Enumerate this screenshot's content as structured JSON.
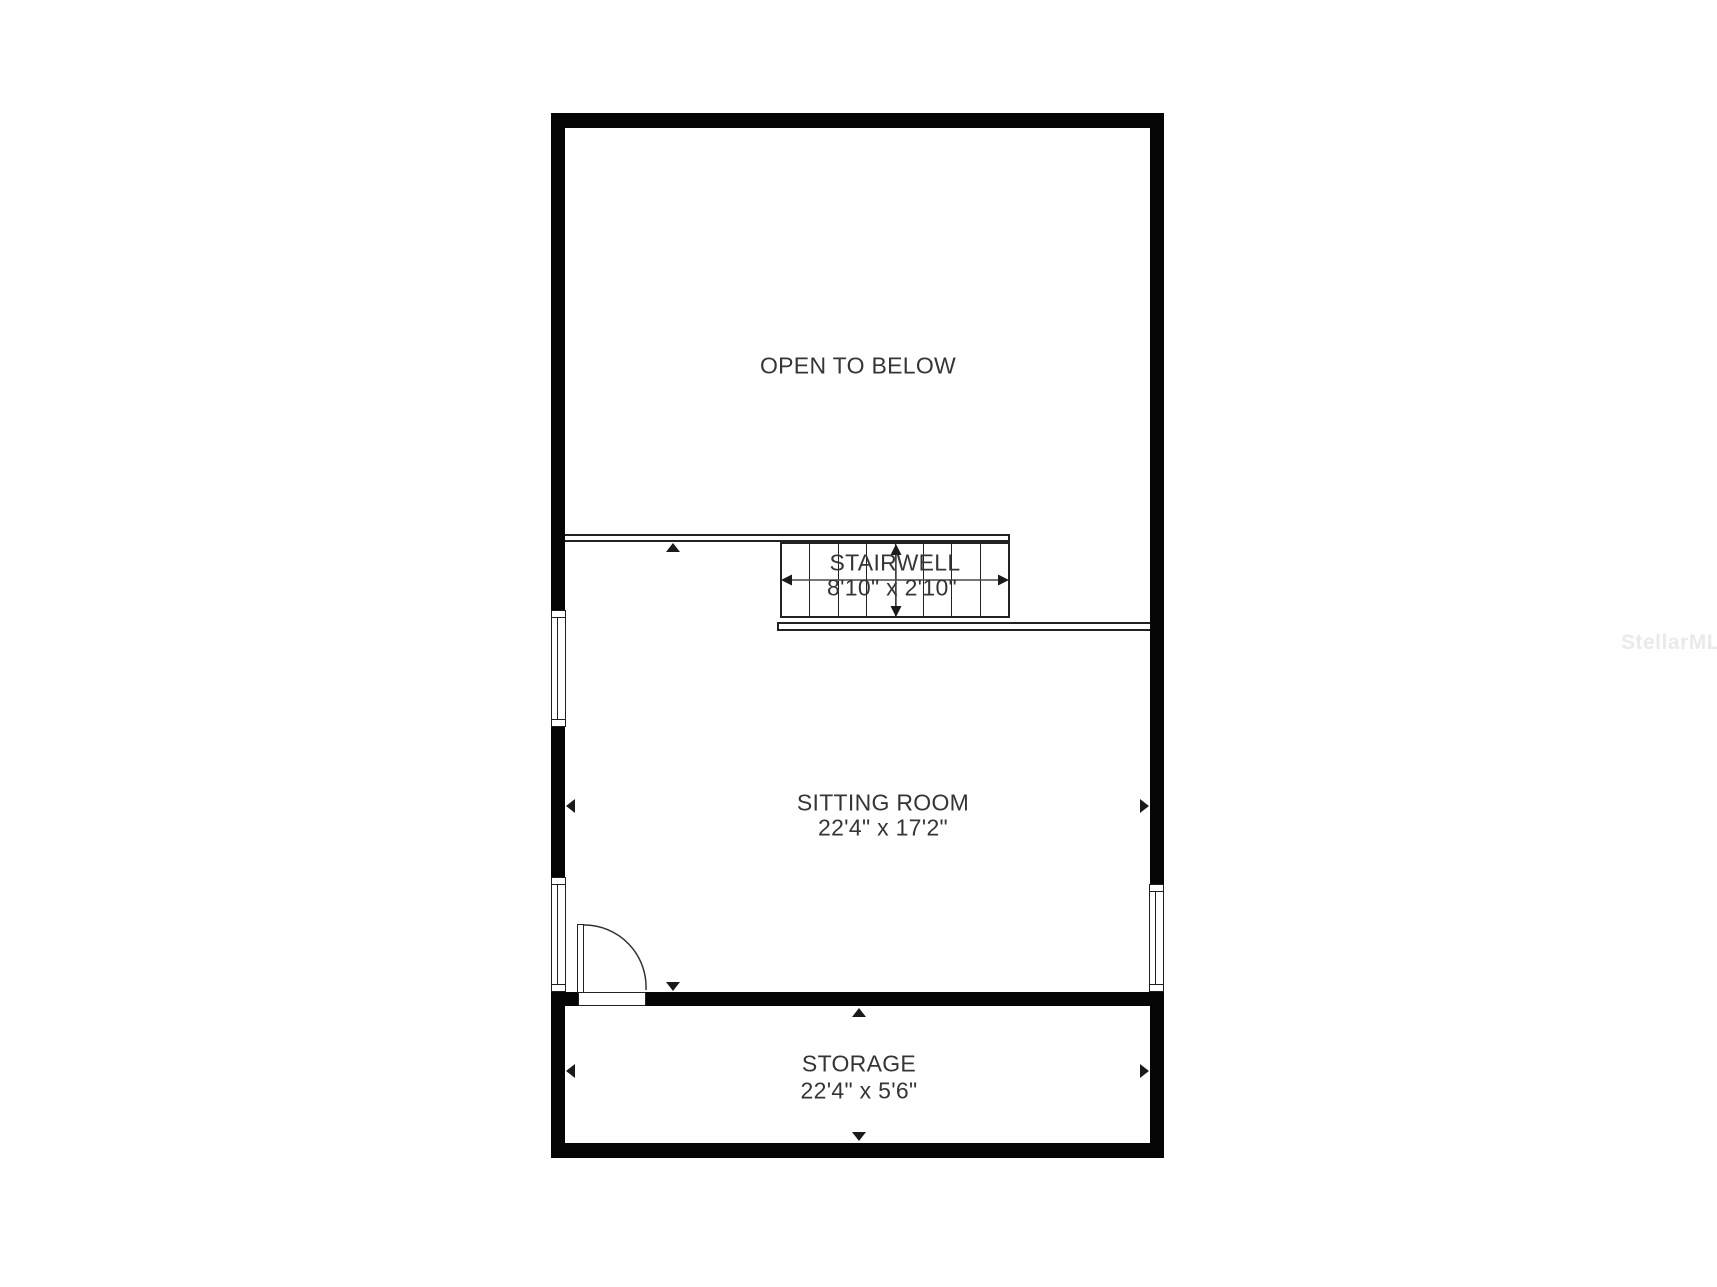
{
  "floorplan": {
    "areas": {
      "open_to_below": {
        "name": "OPEN TO BELOW"
      },
      "stairwell": {
        "name": "STAIRWELL",
        "dimensions": "8'10\" x 2'10\""
      },
      "sitting_room": {
        "name": "SITTING ROOM",
        "dimensions": "22'4\" x 17'2\""
      },
      "storage": {
        "name": "STORAGE",
        "dimensions": "22'4\" x 5'6\""
      }
    },
    "watermark": "StellarMLS",
    "colors": {
      "wall": "#050505",
      "line": "#222222",
      "dimension_arrow": "#4a4a4a",
      "text": "#353535",
      "watermark": "#eaeaea",
      "background": "#ffffff"
    }
  }
}
